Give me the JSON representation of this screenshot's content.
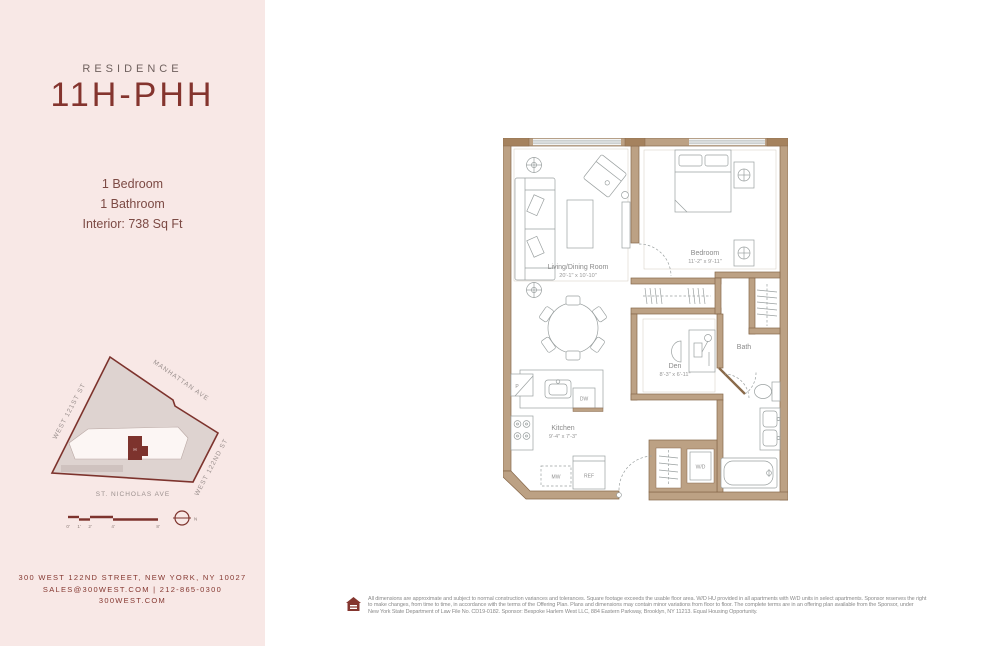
{
  "colors": {
    "accent_maroon": "#84342e",
    "sidebar_bg": "#f8e8e6",
    "wall_tan": "#bca184",
    "wall_outline": "#87684a",
    "label_gray": "#8a8a8a"
  },
  "sidebar": {
    "residence_label": "RESIDENCE",
    "residence_name": "11H-PHH",
    "details": [
      "1 Bedroom",
      "1 Bathroom",
      "Interior: 738 Sq Ft"
    ],
    "siteplan": {
      "street_top": "MANHATTAN AVE",
      "street_left": "WEST 121ST ST",
      "street_right": "WEST 122ND ST",
      "street_bottom": "ST. NICHOLAS AVE",
      "unit_marker": "H",
      "scale_ticks": [
        "0'",
        "1'",
        "2'",
        "4'",
        "8'"
      ],
      "compass_label": "N"
    },
    "address_line1": "300 WEST 122ND STREET, NEW YORK, NY 10027",
    "address_line2": "SALES@300WEST.COM  |  212-865-0300",
    "address_line3": "300WEST.COM"
  },
  "floorplan": {
    "rooms": [
      {
        "name": "Living/Dining Room",
        "dims": "20'-1\" x 10'-10\""
      },
      {
        "name": "Bedroom",
        "dims": "11'-2\" x 9'-11\""
      },
      {
        "name": "Den",
        "dims": "8'-3\" x 6'-11\""
      },
      {
        "name": "Kitchen",
        "dims": "9'-4\" x 7'-3\""
      },
      {
        "name": "Bath",
        "dims": ""
      }
    ],
    "labels": {
      "pantry": "P",
      "dishwasher": "DW",
      "microwave": "MW",
      "refrigerator": "REF",
      "washer_dryer": "W/D"
    }
  },
  "footer": {
    "disclaimer_lines": [
      "All dimensions are approximate and subject to normal construction variances and tolerances. Square footage exceeds the usable floor area. W/D HU provided in all apartments with W/D units in select apartments. Sponsor reserves the right",
      "to make changes, from time to time, in accordance with the terms of the Offering Plan. Plans and dimensions may contain minor variations from floor to floor. The complete terms are in an offering plan available from the Sponsor, under",
      "New York State Department of Law File No. CD19-0182. Sponsor: Bespoke Harlem West LLC, 884 Eastern Parkway, Brooklyn, NY 11213. Equal Housing Opportunity."
    ]
  }
}
